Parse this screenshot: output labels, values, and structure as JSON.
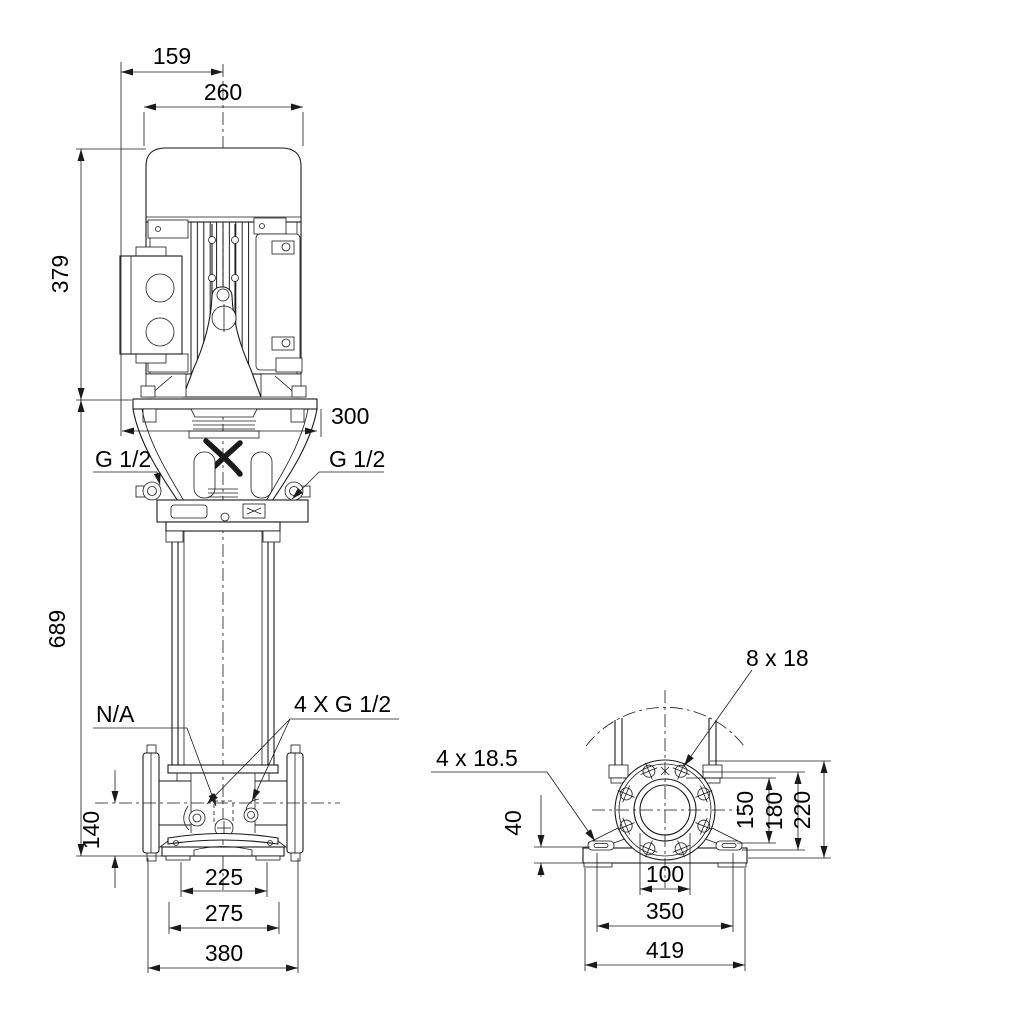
{
  "colors": {
    "background": "#ffffff",
    "line": "#1a1a1a",
    "text": "#000000"
  },
  "front": {
    "dim_159": "159",
    "dim_260": "260",
    "dim_379": "379",
    "dim_300": "300",
    "plug_left": "G 1/2",
    "plug_right": "G 1/2",
    "dim_689": "689",
    "port_na": "N/A",
    "plugs_4x": "4 X G 1/2",
    "dim_140": "140",
    "dim_225": "225",
    "dim_275": "275",
    "dim_380": "380"
  },
  "side": {
    "flange_holes": "8 x 18",
    "foot_holes": "4 x 18.5",
    "dim_40": "40",
    "dim_150": "150",
    "dim_180": "180",
    "dim_220": "220",
    "dim_100": "100",
    "dim_350": "350",
    "dim_419": "419"
  }
}
